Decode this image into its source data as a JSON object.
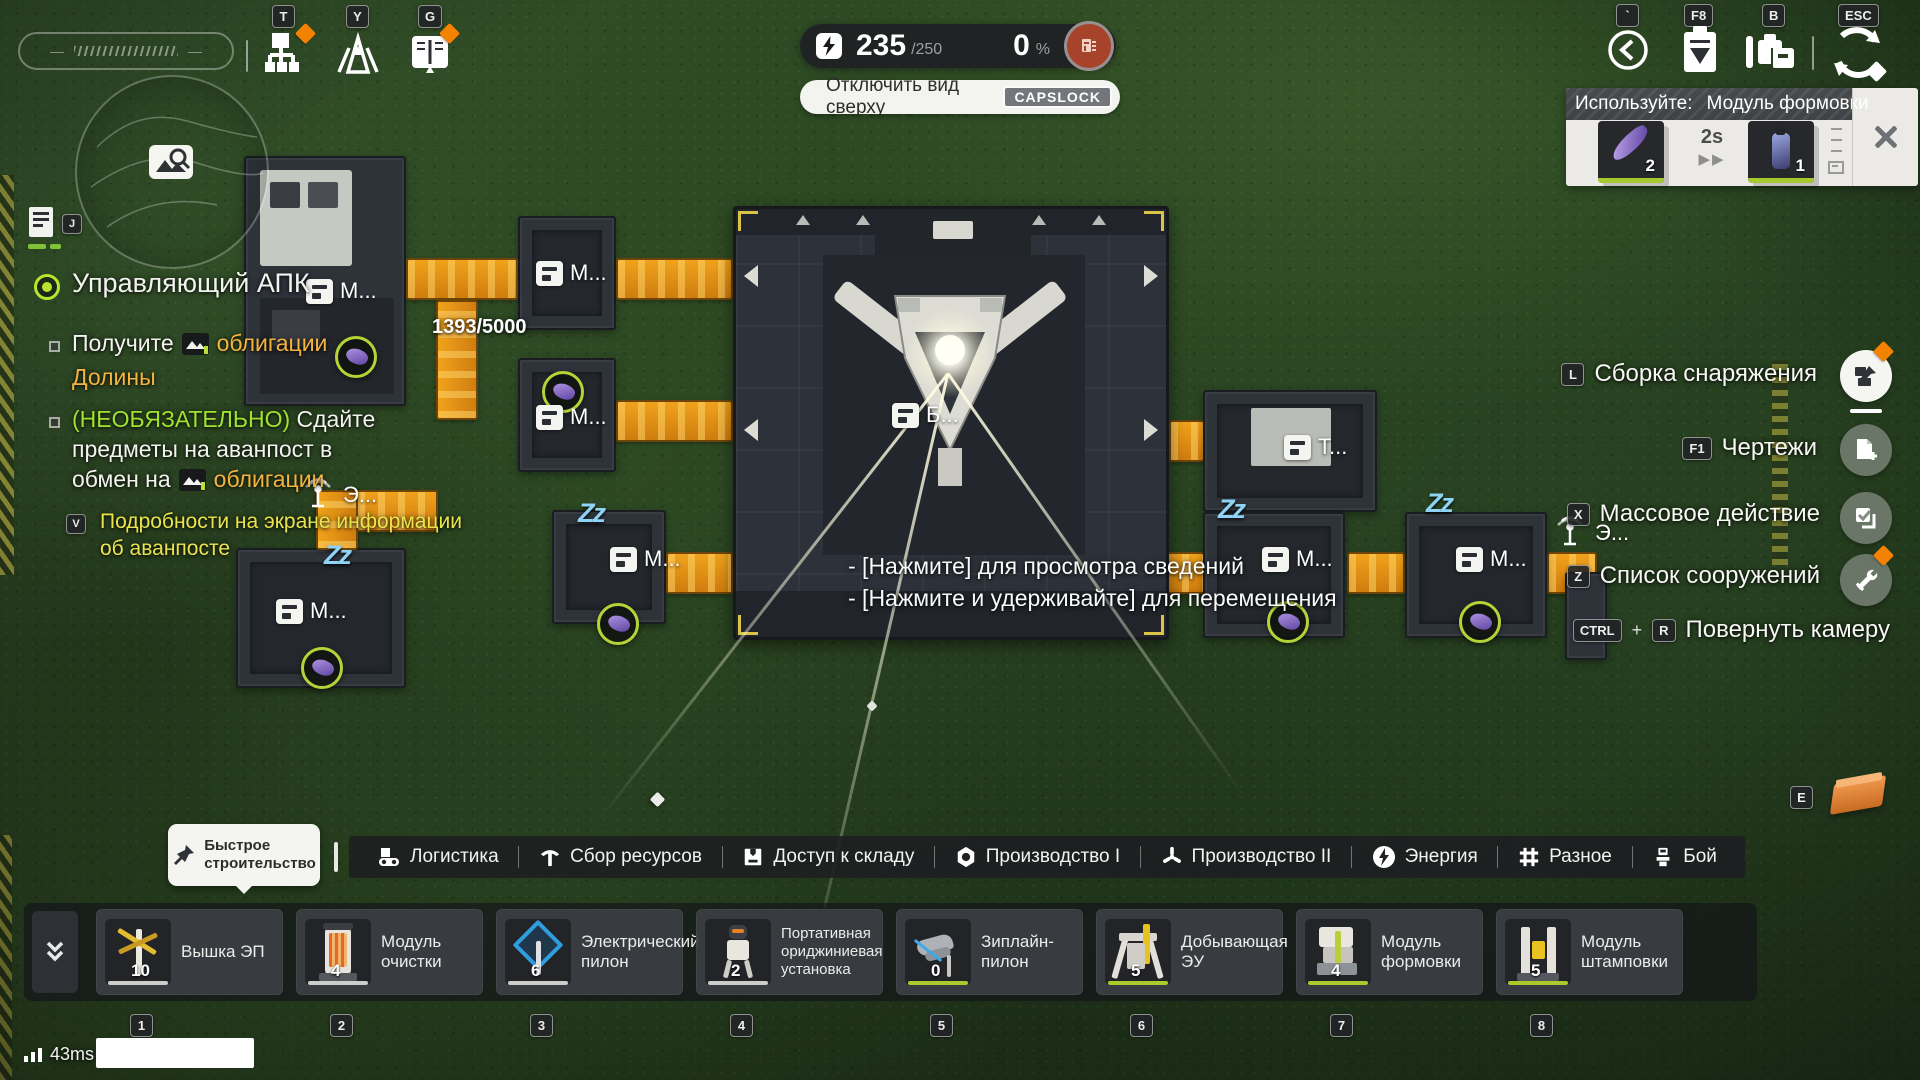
{
  "icons": {
    "fast_forward": "▶▶",
    "sleep": "Zz",
    "compass_dash": "—"
  },
  "hotkeys": {
    "tech_tree": "T",
    "expedition": "Y",
    "handbook": "G",
    "tracker": "J",
    "back": "`",
    "tasks": "F8",
    "inventory": "B",
    "menu": "ESC",
    "gear_assembly": "L",
    "blueprints": "F1",
    "mass_action": "X",
    "structure_list": "Z",
    "rotate_mod": "CTRL",
    "rotate_plus": "+",
    "rotate_key": "R",
    "pickup": "E",
    "hint": "V",
    "top_view": "CAPSLOCK"
  },
  "power": {
    "value": "235",
    "max": "/250",
    "percent": "0",
    "unit": "%"
  },
  "top_view_label": "Отключить вид сверху",
  "use_panel": {
    "prefix": "Используйте:",
    "item": "Модуль формовки",
    "input_count": "2",
    "duration": "2s",
    "output_count": "1"
  },
  "quest": {
    "title": "Управляющий АПК",
    "obj1_text": "Получите",
    "obj1_link": "облигации",
    "obj1_line2": "Долины",
    "obj2_optional": "(НЕОБЯЗАТЕЛЬНО)",
    "obj2_rest": " Сдайте",
    "obj2_line2": "предметы на аванпост в",
    "obj2_line3": "обмен на",
    "obj2_link": "облигации",
    "hint_line1": "Подробности на экране информации",
    "hint_line2": "об аванпосте"
  },
  "map": {
    "storage_count": "1393/5000",
    "tooltip_line1": "- [Нажмите] для просмотра сведений",
    "tooltip_line2": "- [Нажмите и удерживайте] для перемещения",
    "labels": [
      {
        "text": "М..."
      },
      {
        "text": "М..."
      },
      {
        "text": "М..."
      },
      {
        "text": "М..."
      },
      {
        "text": "М..."
      },
      {
        "text": "Б..."
      },
      {
        "text": "Т..."
      },
      {
        "text": "М..."
      },
      {
        "text": "М..."
      },
      {
        "text": "Э..."
      },
      {
        "text": "Э..."
      }
    ]
  },
  "right_menu": {
    "items": [
      {
        "key": "L",
        "label": "Сборка снаряжения"
      },
      {
        "key": "F1",
        "label": "Чертежи"
      },
      {
        "key": "X",
        "label": "Массовое действие"
      },
      {
        "key": "Z",
        "label": "Список сооружений"
      }
    ],
    "rotate_label": "Повернуть камеру"
  },
  "quick_build": {
    "line1": "Быстрое",
    "line2": "строительство"
  },
  "tabs": [
    {
      "label": "Логистика"
    },
    {
      "label": "Сбор ресурсов"
    },
    {
      "label": "Доступ к складу"
    },
    {
      "label": "Производство I"
    },
    {
      "label": "Производство II"
    },
    {
      "label": "Энергия"
    },
    {
      "label": "Разное"
    },
    {
      "label": "Бой"
    }
  ],
  "hotbar": [
    {
      "key": "1",
      "name": "Вышка ЭП",
      "count": "10"
    },
    {
      "key": "2",
      "name": "Модуль очистки",
      "count": "4"
    },
    {
      "key": "3",
      "name": "Электрический пилон",
      "count": "6"
    },
    {
      "key": "4",
      "name": "Портативная ориджиниевая установка",
      "count": "2"
    },
    {
      "key": "5",
      "name": "Зиплайн-пилон",
      "count": "0"
    },
    {
      "key": "6",
      "name": "Добывающая ЭУ",
      "count": "5"
    },
    {
      "key": "7",
      "name": "Модуль формовки",
      "count": "4"
    },
    {
      "key": "8",
      "name": "Модуль штамповки",
      "count": "5"
    }
  ],
  "status": {
    "ping": "43ms"
  }
}
